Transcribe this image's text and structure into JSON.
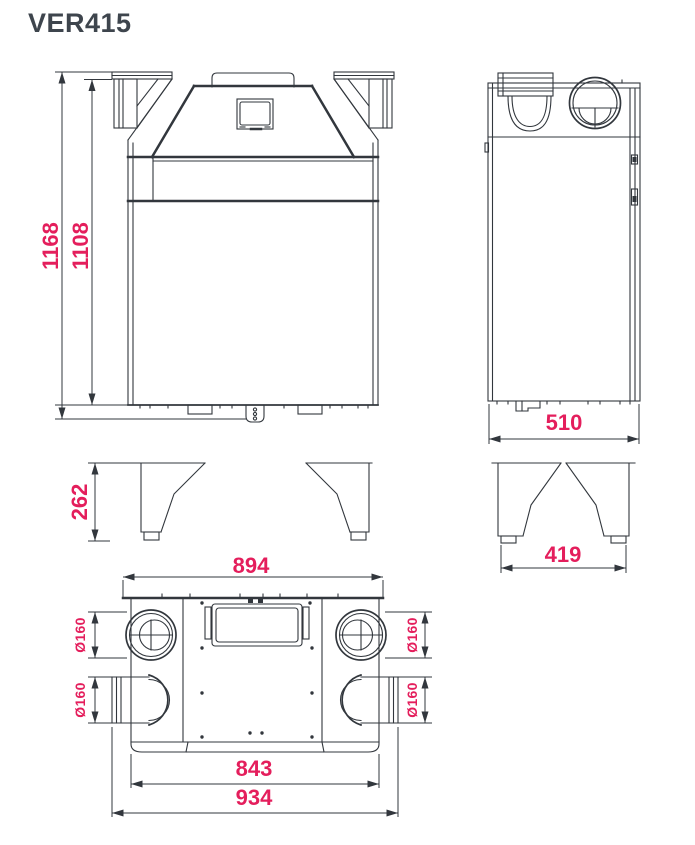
{
  "page": {
    "title": "VER415",
    "accent_color": "#e41e5c",
    "ink_color": "#32373d",
    "title_color": "#3e454d"
  },
  "dimensions": {
    "front_total_height": "1168",
    "front_body_height": "1108",
    "side_depth": "510",
    "leg_height": "262",
    "leg_base_depth": "419",
    "top_flange_width": "894",
    "top_body_width": "843",
    "top_overall_width": "934",
    "duct_top_left_diameter": "Ø160",
    "duct_bottom_left_diameter": "Ø160",
    "duct_top_right_diameter": "Ø160",
    "duct_bottom_right_diameter": "Ø160"
  }
}
